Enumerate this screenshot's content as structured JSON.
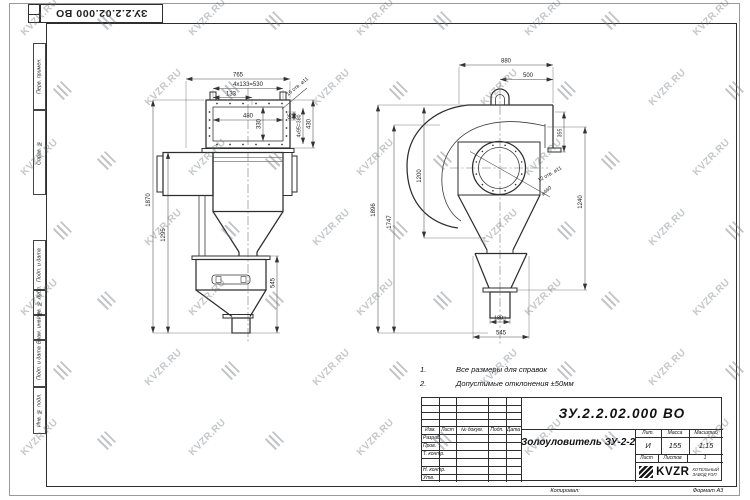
{
  "watermark": {
    "text": "KVZR.RU"
  },
  "frame": {
    "top_designation": "ЗУ.2.2.02.000 ВО",
    "margin_labels": [
      "Перв. примен.",
      "Справ. №",
      "Подп. и дата",
      "Инв. № дубл.",
      "Взам. инв. №",
      "Подп. и дата",
      "Инв. № подл."
    ]
  },
  "views": {
    "front": {
      "dims": {
        "width_overall": "765",
        "bolt_row": "4x133=530",
        "bolt_step": "133",
        "inner_width": "480",
        "inner_height": "330",
        "bolt_pitch": "95",
        "bolt_col": "4x95=380",
        "flange_height": "430",
        "holes_note": "16 отв. ⌀11",
        "height_overall": "1870",
        "height_body": "1295",
        "hopper_height": "545"
      }
    },
    "side": {
      "dims": {
        "width_overall": "880",
        "outlet_offset": "500",
        "height_overall": "1896",
        "height_inner": "1747",
        "inlet_height": "1200",
        "outlet_height": "1240",
        "outlet_len": "355",
        "holes_note": "12 отв. ⌀11",
        "bolt_circle": "⌀460",
        "outlet_square": "180□",
        "hopper_width": "545"
      }
    }
  },
  "notes": {
    "n1_num": "1.",
    "n1_text": "Все размеры для справок",
    "n2_num": "2.",
    "n2_text": "Допустимые отклонения ±50мм"
  },
  "title_block": {
    "designation": "ЗУ.2.2.02.000 ВО",
    "doc_name": "Золоуловитель ЗУ-2-2",
    "cols": {
      "izm": "Изм.",
      "list": "Лист",
      "dokum": "№ докум.",
      "podp": "Подп.",
      "data": "Дата"
    },
    "rows": {
      "razrab": "Разраб.",
      "prov": "Пров.",
      "tkontr": "Т. контр.",
      "nkontr": "Н. контр.",
      "utv": "Утв."
    },
    "lit_label": "Лит.",
    "mass_label": "Масса",
    "scale_label": "Масштаб",
    "lit_value": "И",
    "mass_value": "155",
    "scale_value": "1:15",
    "sheet_label": "Лист",
    "sheets_label": "Листов",
    "sheets_value": "1",
    "logo_text": "KVZR",
    "logo_sub1": "КОТЕЛЬНЫЙ",
    "logo_sub2": "ЗАВОД РЭП",
    "copied_label": "Копировал:",
    "format_label": "Формат А3"
  }
}
